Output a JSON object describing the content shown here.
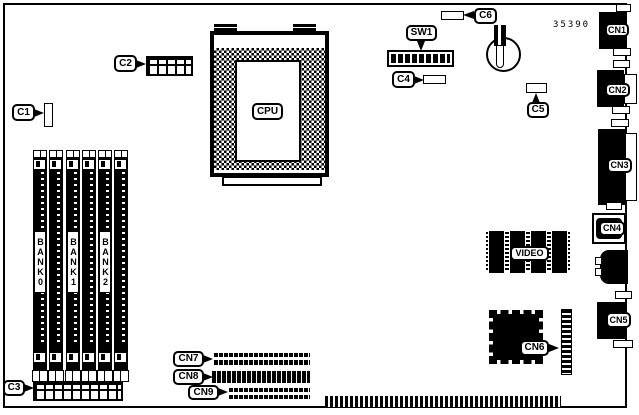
{
  "board": {
    "part_number": "35390",
    "cpu": {
      "label": "CPU"
    },
    "dip_switch": {
      "label": "SW1"
    },
    "video": {
      "label": "VIDEO"
    },
    "memory_banks": [
      {
        "label": "BANK0"
      },
      {
        "label": "BANK1"
      },
      {
        "label": "BANK2"
      }
    ],
    "connectors": {
      "C1": "C1",
      "C2": "C2",
      "C3": "C3",
      "C4": "C4",
      "C5": "C5",
      "C6": "C6",
      "CN1": "CN1",
      "CN2": "CN2",
      "CN3": "CN3",
      "CN4": "CN4",
      "CN5": "CN5",
      "CN6": "CN6",
      "CN7": "CN7",
      "CN8": "CN8",
      "CN9": "CN9"
    }
  }
}
